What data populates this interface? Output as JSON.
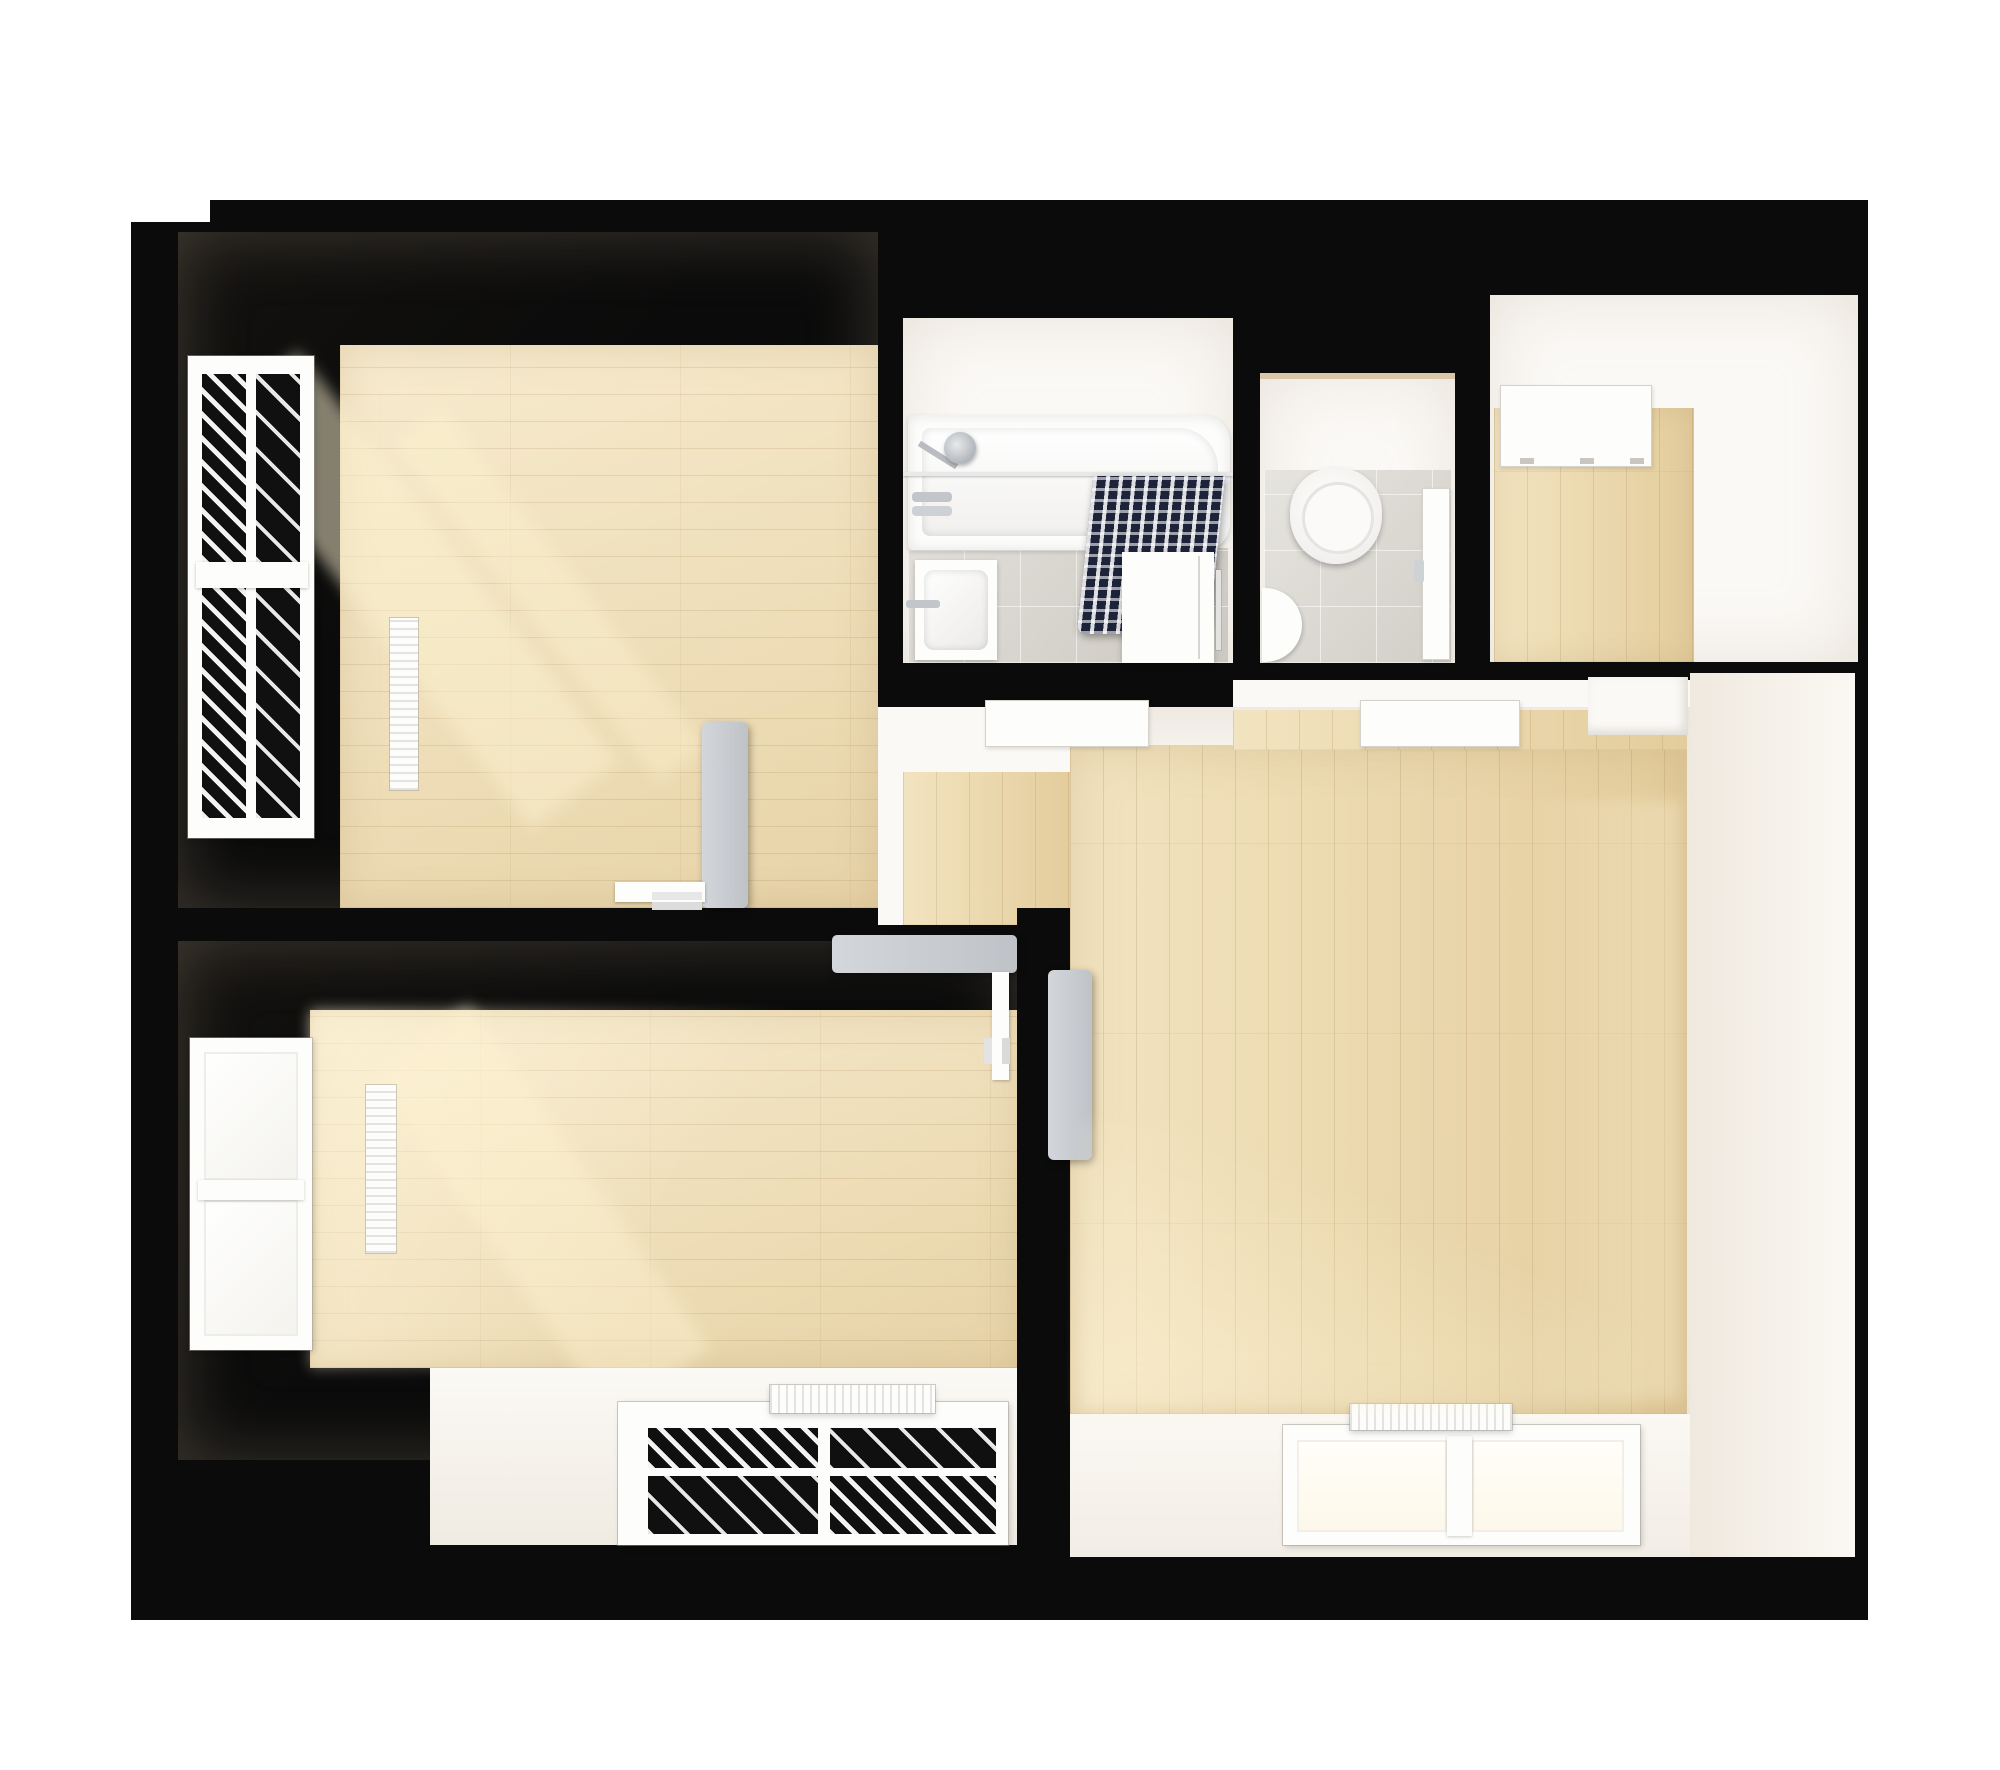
{
  "document": {
    "title": "Apartment Floor Plan - Top-Down 3D Render"
  },
  "palette": {
    "page_bg": "#ffffff",
    "wall": "#0b0b0b",
    "interior_white": "#f7f4ef",
    "ceiling_band": "#fbf9f6",
    "wood_light": "#eeddb5",
    "wood_living": "#ead6a8",
    "tile_bath": "#d8d4cd",
    "tile_wc": "#dedbd4",
    "curtain_navy": "#272e47",
    "door_gray": "#c9ccd1",
    "fixture_white": "#fdfdfc",
    "window_dark": "#101010",
    "sun_glow": "#f8e8c2"
  },
  "rooms": {
    "bedroom1": {
      "label": "Bedroom (top left)",
      "floor": "light wood planks, horizontal",
      "fixtures": [
        "slatted dark window",
        "wall radiator",
        "open gray door"
      ]
    },
    "bedroom2": {
      "label": "Bedroom (bottom left)",
      "floor": "light wood planks, horizontal, sunlit",
      "fixtures": [
        "bright side window",
        "tall radiator",
        "open gray door",
        "window bay with dark double window",
        "bay radiator"
      ]
    },
    "bathroom": {
      "label": "Bathroom",
      "floor": "gray ceramic tile",
      "fixtures": [
        "bathtub",
        "shower head",
        "shower curtain navy striped",
        "sink",
        "washing machine"
      ]
    },
    "wc": {
      "label": "WC",
      "floor": "gray ceramic tile",
      "fixtures": [
        "wall-hung toilet",
        "hand basin",
        "door"
      ]
    },
    "hall": {
      "label": "Entry Hall",
      "floor": "light wood planks, vertical",
      "fixtures": [
        "entrance door"
      ]
    },
    "living": {
      "label": "Living Room",
      "floor": "light wood planks, vertical",
      "fixtures": [
        "bathroom door",
        "wc door",
        "open gray door",
        "wall alcove",
        "bright window bay",
        "window radiator"
      ]
    }
  }
}
